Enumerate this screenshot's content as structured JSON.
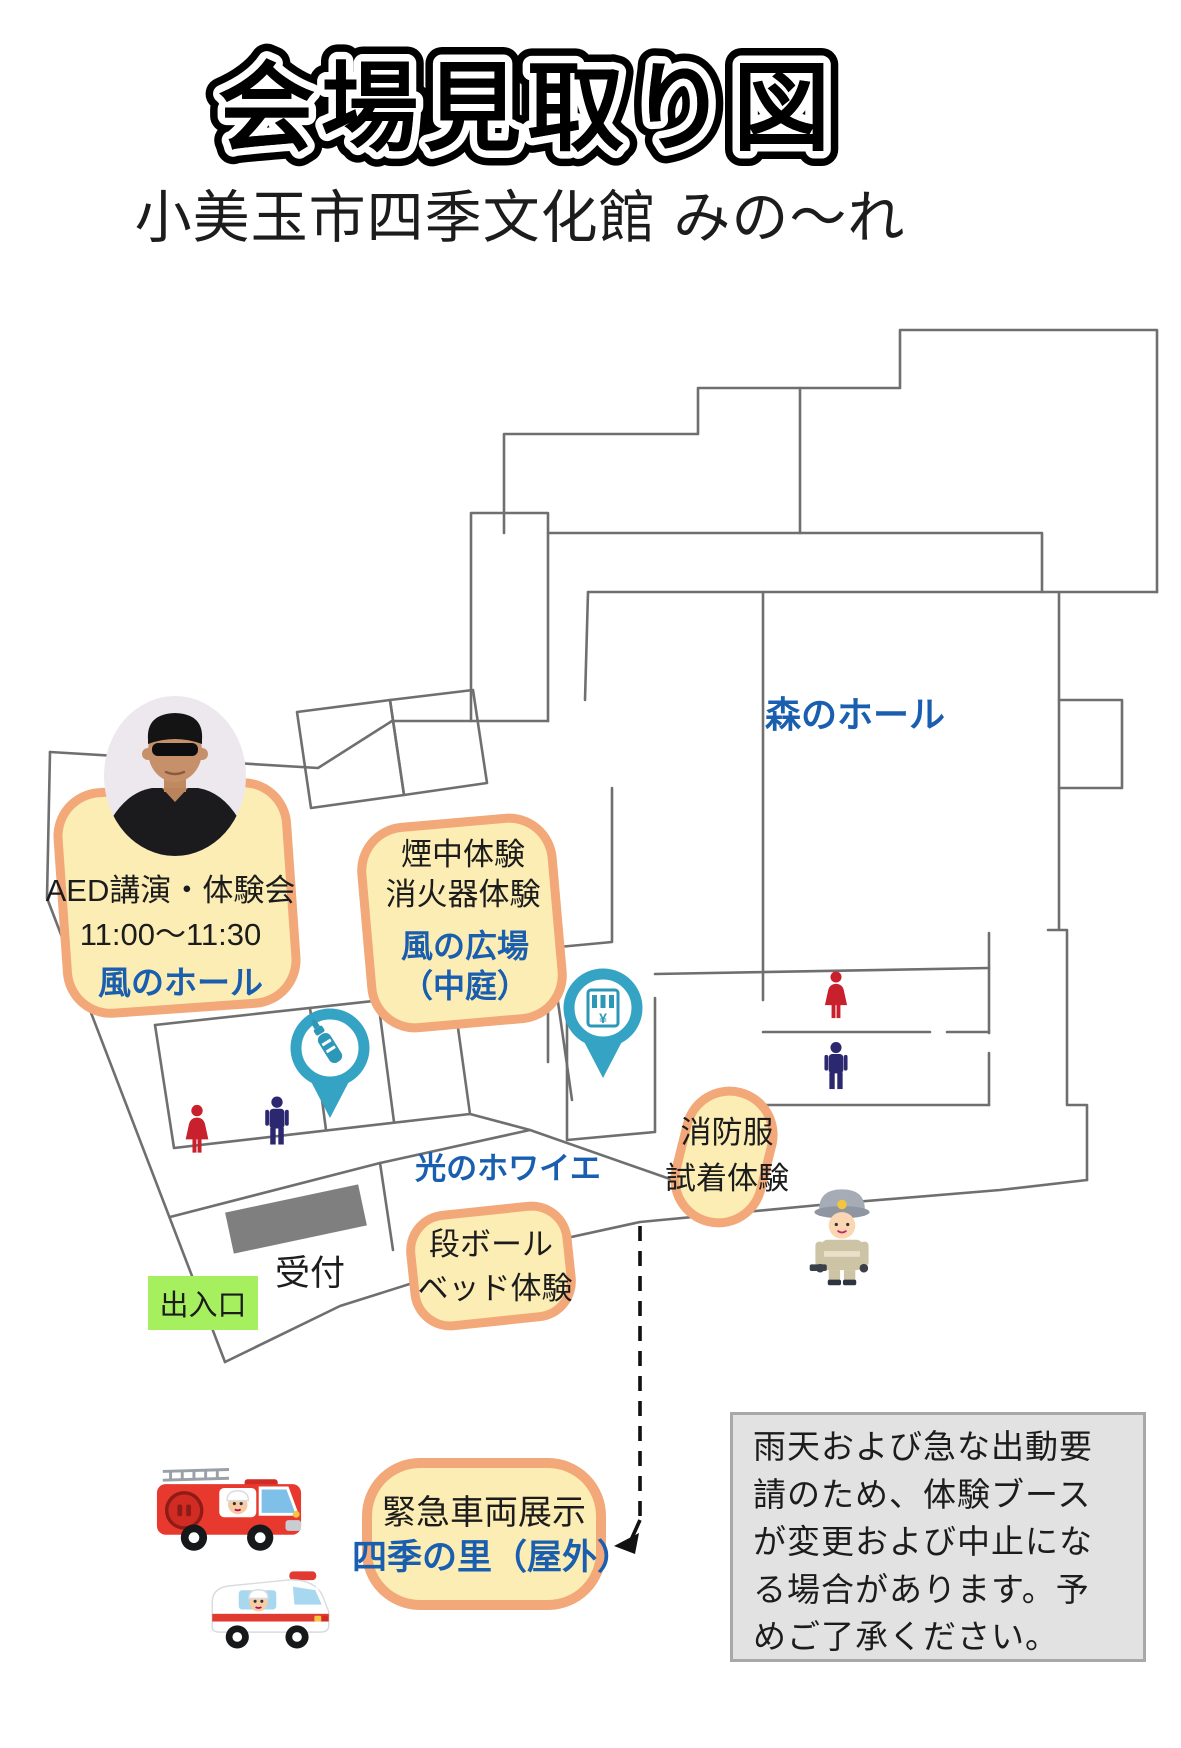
{
  "title": "会場見取り図",
  "subtitle": "小美玉市四季文化館 みの〜れ",
  "labels": {
    "mori_hall": "森のホール",
    "hikari_foyer": "光のホワイエ",
    "reception": "受付",
    "entrance": "出入口"
  },
  "booths": {
    "aed": {
      "name": "AED講演・体験会",
      "time": "11:00〜11:30",
      "place": "風のホール"
    },
    "smoke": {
      "line1": "煙中体験",
      "line2": "消火器体験",
      "place_line1": "風の広場",
      "place_line2": "（中庭）"
    },
    "fire_suit": {
      "line1": "消防服",
      "line2": "試着体験"
    },
    "cardboard_bed": {
      "line1": "段ボール",
      "line2": "ベッド体験"
    },
    "emergency_vehicles": {
      "name": "緊急車両展示",
      "place": "四季の里（屋外）"
    }
  },
  "notice": {
    "text": "雨天および急な出動要請のため、体験ブースが変更および中止になる場合があります。予めご了承ください。"
  },
  "icons": {
    "vending_symbol": "¥",
    "names": [
      "speaker-photo",
      "baby-bottle-pin",
      "vending-machine-pin",
      "woman-restroom-icon",
      "man-restroom-icon",
      "firefighter-character",
      "fire-truck-illustration",
      "ambulance-illustration"
    ]
  },
  "colors": {
    "highlight_fill": "#FBEDB4",
    "highlight_border": "#F2A878",
    "accent_blue": "#1A5EB0",
    "pin_teal": "#35A3C4",
    "entrance_green": "#A6F05F",
    "woman_red": "#C8202C",
    "man_navy": "#2B2870",
    "wall_gray": "#6F6F6F",
    "notice_bg": "#E2E2E2"
  }
}
